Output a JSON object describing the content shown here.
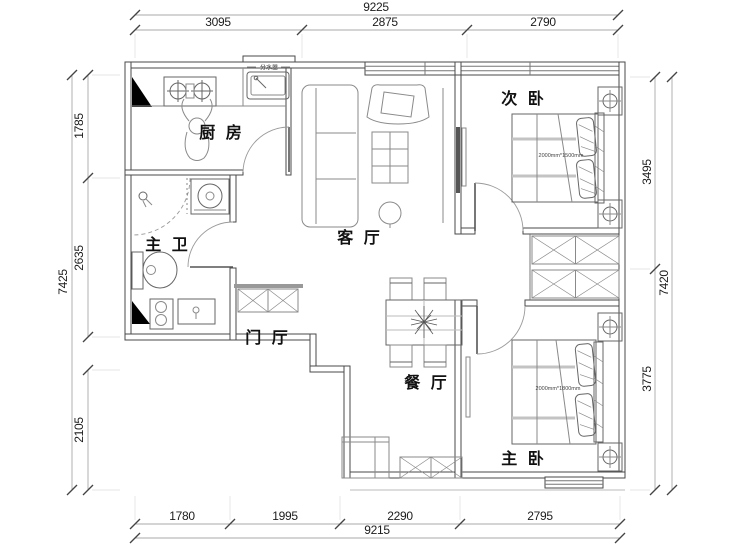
{
  "floorplan": {
    "rooms": {
      "kitchen": "厨 房",
      "master_bath": "主 卫",
      "foyer": "门 厅",
      "living": "客 厅",
      "dining": "餐 厅",
      "second_bedroom": "次 卧",
      "master_bedroom": "主 卧"
    },
    "annotations": {
      "water_manifold": "分水器",
      "second_bed_size": "2000mm*1500mm",
      "master_bed_size": "2000mm*1800mm"
    },
    "dimensions": {
      "top": {
        "overall": "9225",
        "segments": [
          "3095",
          "2875",
          "2790"
        ]
      },
      "bottom": {
        "overall": "9215",
        "segments": [
          "1780",
          "1995",
          "2290",
          "2795"
        ]
      },
      "left": {
        "overall": "7425",
        "segments": [
          "1785",
          "2635",
          "2105"
        ]
      },
      "right": {
        "overall": "7420",
        "segments": [
          "3495",
          "3775"
        ]
      }
    },
    "colors": {
      "wall_line": "#4a4a4a",
      "furniture_line": "#8a8a8a",
      "dimension_text": "#1c1c1c",
      "solid_fill": "#000000",
      "background": "#ffffff"
    }
  }
}
